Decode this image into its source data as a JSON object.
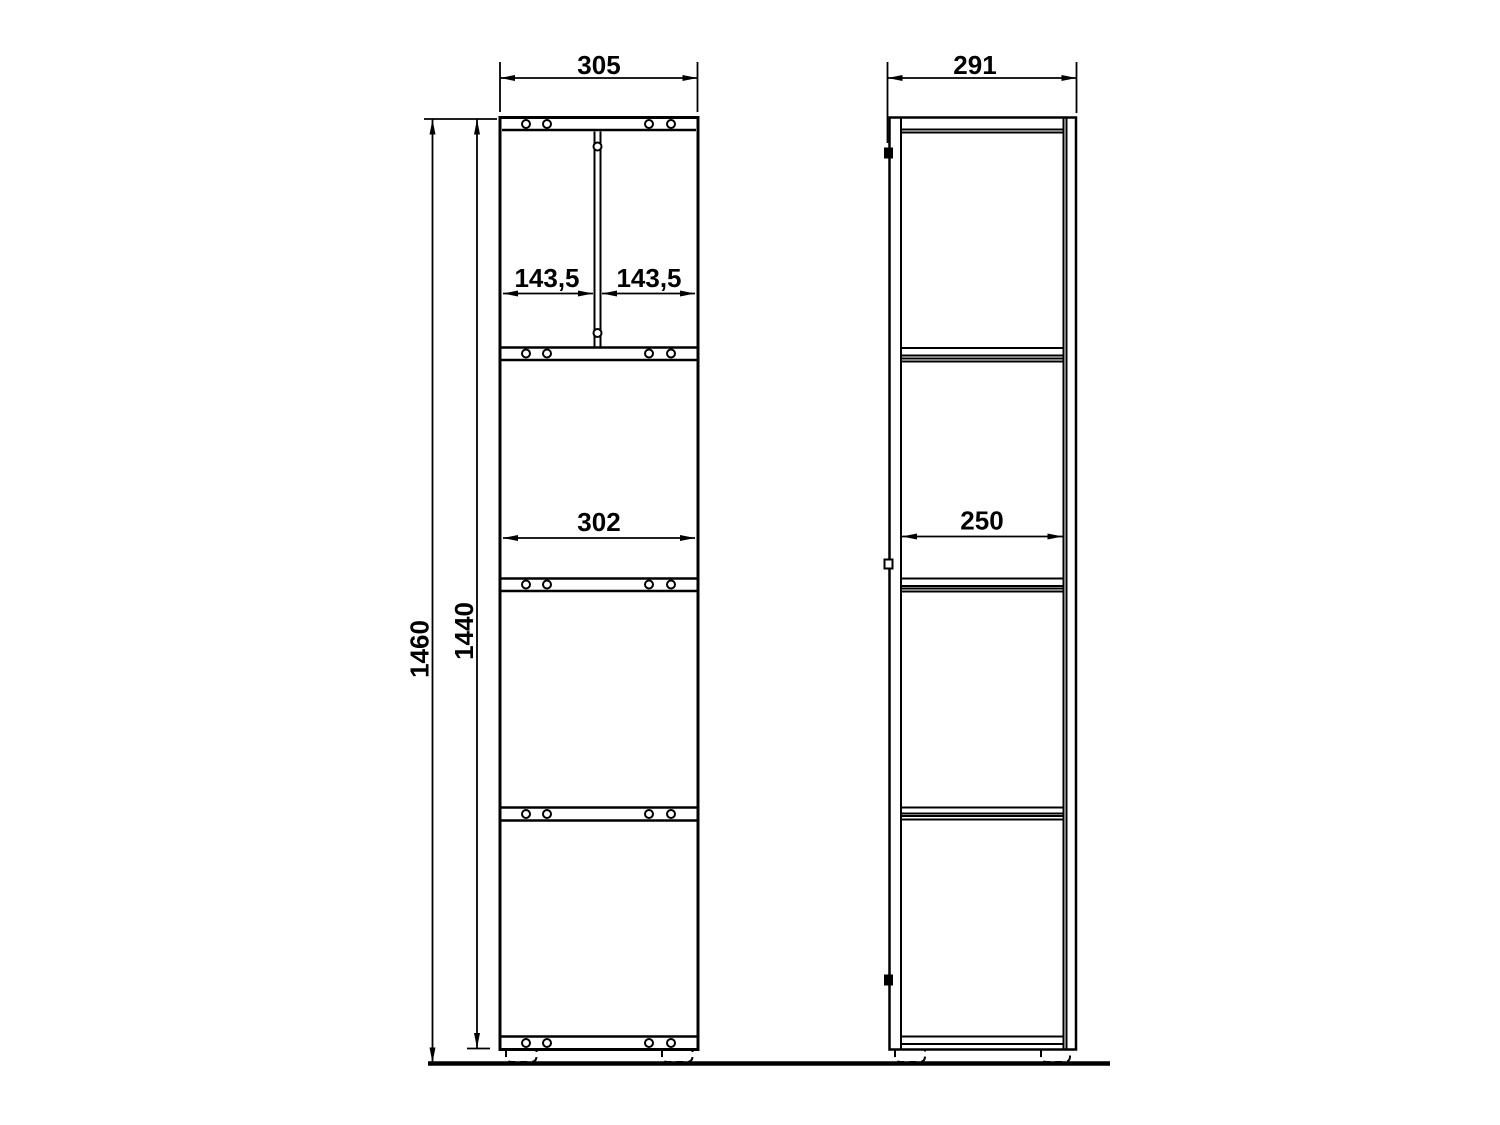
{
  "canvas": {
    "background": "#ffffff",
    "line_color": "#000000"
  },
  "dimensions": {
    "front_overall_width": "305",
    "side_overall_depth": "291",
    "top_left_compartment_width": "143,5",
    "top_right_compartment_width": "143,5",
    "interior_width": "302",
    "interior_depth": "250",
    "overall_height": "1460",
    "carcass_height": "1440"
  }
}
